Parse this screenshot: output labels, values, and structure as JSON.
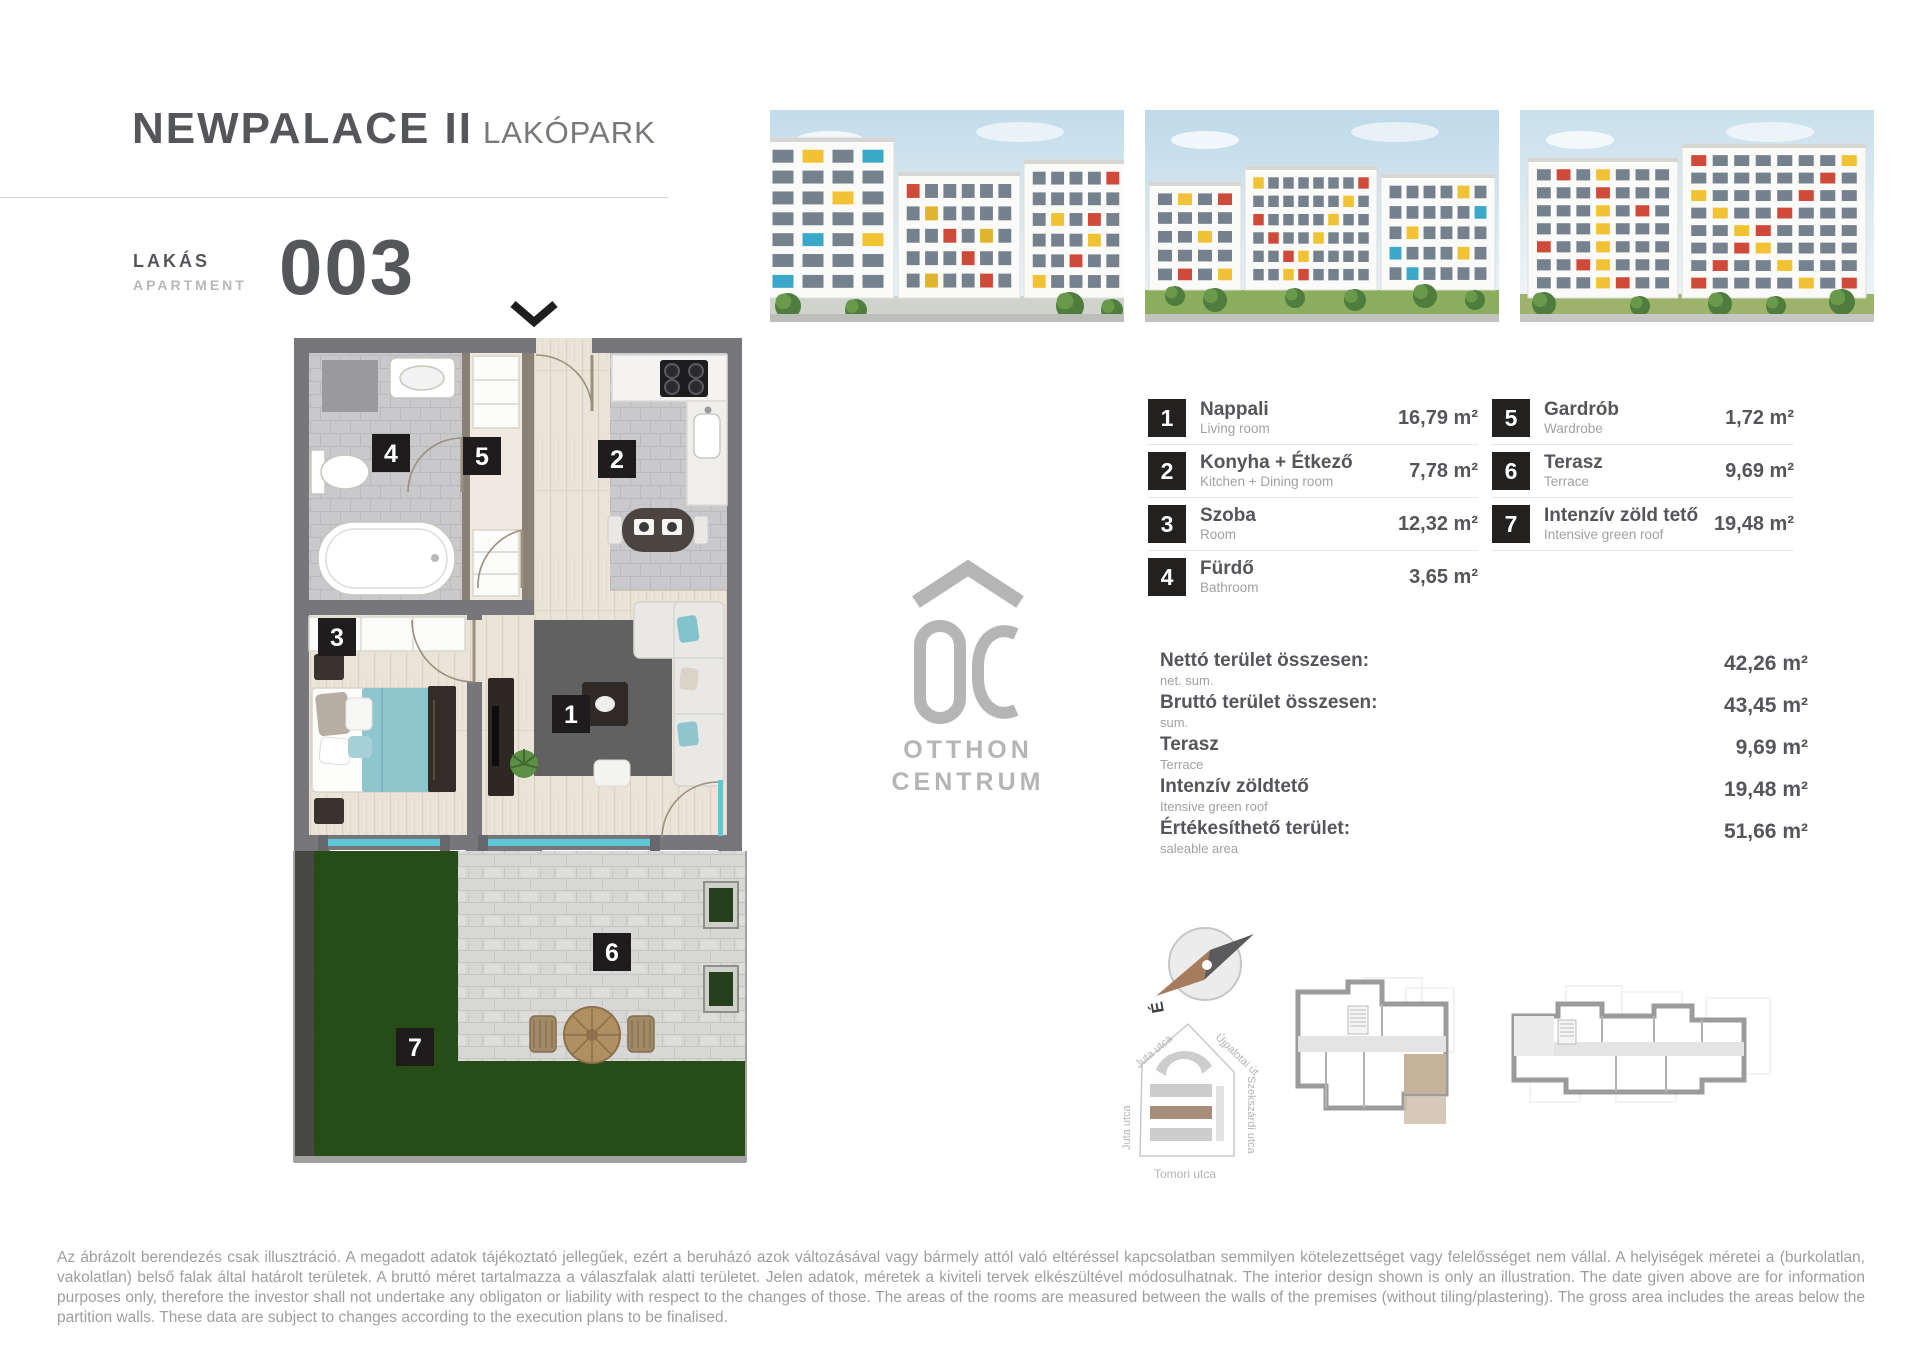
{
  "header": {
    "title_main": "NEWPALACE II",
    "title_sub": "LAKÓPARK",
    "apartment_label_hu": "LAKÁS",
    "apartment_label_en": "APARTMENT",
    "apartment_number": "003"
  },
  "plan": {
    "badges": [
      "1",
      "2",
      "3",
      "4",
      "5",
      "6",
      "7"
    ]
  },
  "legend": {
    "rooms": [
      {
        "num": "1",
        "hu": "Nappali",
        "en": "Living room",
        "area": "16,79 m²"
      },
      {
        "num": "2",
        "hu": "Konyha + Étkező",
        "en": "Kitchen + Dining room",
        "area": "7,78 m²"
      },
      {
        "num": "3",
        "hu": "Szoba",
        "en": "Room",
        "area": "12,32 m²"
      },
      {
        "num": "4",
        "hu": "Fürdő",
        "en": "Bathroom",
        "area": "3,65 m²"
      },
      {
        "num": "5",
        "hu": "Gardrób",
        "en": "Wardrobe",
        "area": "1,72 m²"
      },
      {
        "num": "6",
        "hu": "Terasz",
        "en": "Terrace",
        "area": "9,69 m²"
      },
      {
        "num": "7",
        "hu": "Intenzív zöld tető",
        "en": "Intensive green roof",
        "area": "19,48 m²"
      }
    ]
  },
  "summary": {
    "rows": [
      {
        "hu": "Nettó terület összesen:",
        "en": "net. sum.",
        "value": "42,26 m²"
      },
      {
        "hu": "Bruttó terület összesen:",
        "en": "sum.",
        "value": "43,45 m²"
      },
      {
        "hu": "Terasz",
        "en": "Terrace",
        "value": "9,69 m²"
      },
      {
        "hu": "Intenzív zöldtető",
        "en": "Itensive green roof",
        "value": "19,48 m²"
      },
      {
        "hu": "Értékesíthető terület:",
        "en": "saleable area",
        "value": "51,66 m²"
      }
    ]
  },
  "logo": {
    "mark": "OC",
    "line1": "OTTHON",
    "line2": "CENTRUM"
  },
  "compass": {
    "north": "É"
  },
  "sitemap": {
    "streets": {
      "juta": "Juta utca",
      "ujpalotai": "Újpalotai út",
      "szekszardi": "Szekszárdi utca",
      "tomori": "Tomori utca"
    }
  },
  "disclaimer": "Az ábrázolt berendezés csak illusztráció. A megadott adatok tájékoztató jellegűek, ezért a beruházó azok változásával vagy bármely attól való eltéréssel kapcsolatban semmilyen kötelezettséget vagy felelősséget nem vállal. A helyiségek méretei a (burkolatlan, vakolatlan) belső falak által határolt területek. A bruttó méret tartalmazza a válaszfalak alatti területet. Jelen adatok, méretek a kiviteli tervek elkészültével módosulhatnak. The interior design shown is only an illustration. The date given above are for information purposes only, therefore the investor shall not undertake any obligaton or liability with respect to the changes of those. The areas of the rooms are measured between the walls of the premises (without tiling/plastering). The gross area includes the areas below the partition walls. These data are subject to changes according to the execution plans to be finalised.",
  "colors": {
    "accent_dark": "#55565a",
    "text_light": "#9fa1a4",
    "badge_bg": "#232020",
    "wall_gray": "#77777b",
    "glass_teal": "#5fc8d7",
    "lawn_green": "#4d9b31",
    "terrace_paver": "#d7d7d5",
    "highlight_tan": "#c4b29a",
    "logo_gray": "#b5b5b5"
  }
}
